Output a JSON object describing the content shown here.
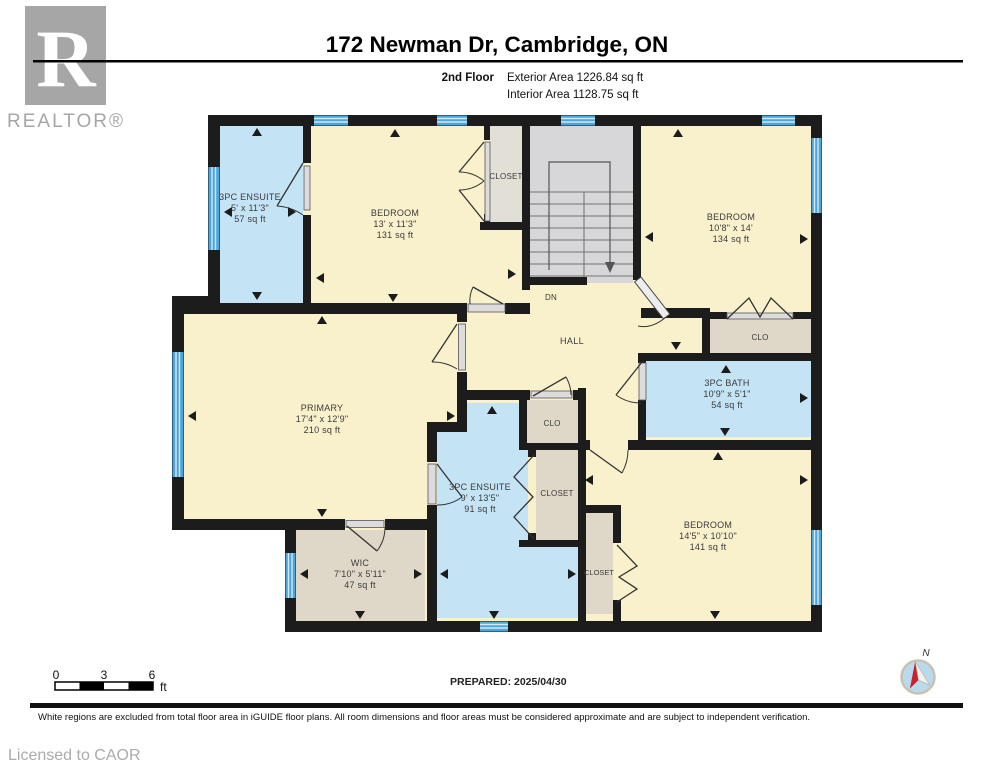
{
  "palette": {
    "wall": "#1c1c1c",
    "beige": "#F9F0CC",
    "blue": "#C4E3F5",
    "tan": "#DFD8C8",
    "tan2": "#E2DFD6",
    "stair": "#D7D7D9",
    "window": "#4FA5D8",
    "door_slab": "#DCDCDC",
    "label": "#3b3b3b",
    "logo_gray": "#A6A6A6",
    "muted": "#ABABAB",
    "compass_fill": "#B9DAEC",
    "compass_ring": "#C9C2B2",
    "compass_red": "#C8202F"
  },
  "header": {
    "title": "172 Newman Dr, Cambridge, ON",
    "floor": "2nd Floor",
    "exterior_area": "Exterior Area 1226.84 sq ft",
    "interior_area": "Interior Area 1128.75 sq ft"
  },
  "branding": {
    "realtor_r": "R",
    "realtor_word": "REALTOR®"
  },
  "rooms": {
    "ensuite_tl": {
      "name": "3PC ENSUITE",
      "dims": "5' x 11'3\"",
      "area": "57 sq ft"
    },
    "bedroom_tl": {
      "name": "BEDROOM",
      "dims": "13' x 11'3\"",
      "area": "131 sq ft"
    },
    "bedroom_tr": {
      "name": "BEDROOM",
      "dims": "10'8\" x 14'",
      "area": "134 sq ft"
    },
    "bath": {
      "name": "3PC BATH",
      "dims": "10'9\" x 5'1\"",
      "area": "54 sq ft"
    },
    "primary": {
      "name": "PRIMARY",
      "dims": "17'4\" x 12'9\"",
      "area": "210 sq ft"
    },
    "ensuite_b": {
      "name": "3PC ENSUITE",
      "dims": "9' x 13'5\"",
      "area": "91 sq ft"
    },
    "wic": {
      "name": "WIC",
      "dims": "7'10\" x 5'11\"",
      "area": "47 sq ft"
    },
    "bedroom_br": {
      "name": "BEDROOM",
      "dims": "14'5\" x 10'10\"",
      "area": "141 sq ft"
    }
  },
  "labels": {
    "dn": "DN",
    "hall": "HALL",
    "closet_top": "CLOSET",
    "clo_right": "CLO",
    "clo_small": "CLO",
    "closet_mid": "CLOSET",
    "closet_bottom": "CLOSET"
  },
  "scalebar": {
    "t0": "0",
    "t3": "3",
    "t6": "6",
    "unit": "ft"
  },
  "compass": {
    "north": "N"
  },
  "footer": {
    "prepared": "PREPARED: 2025/04/30",
    "disclaimer": "White regions are excluded from total floor area in iGUIDE floor plans. All room dimensions and floor areas must be considered approximate and are subject to independent verification.",
    "licensed": "Licensed to CAOR"
  }
}
